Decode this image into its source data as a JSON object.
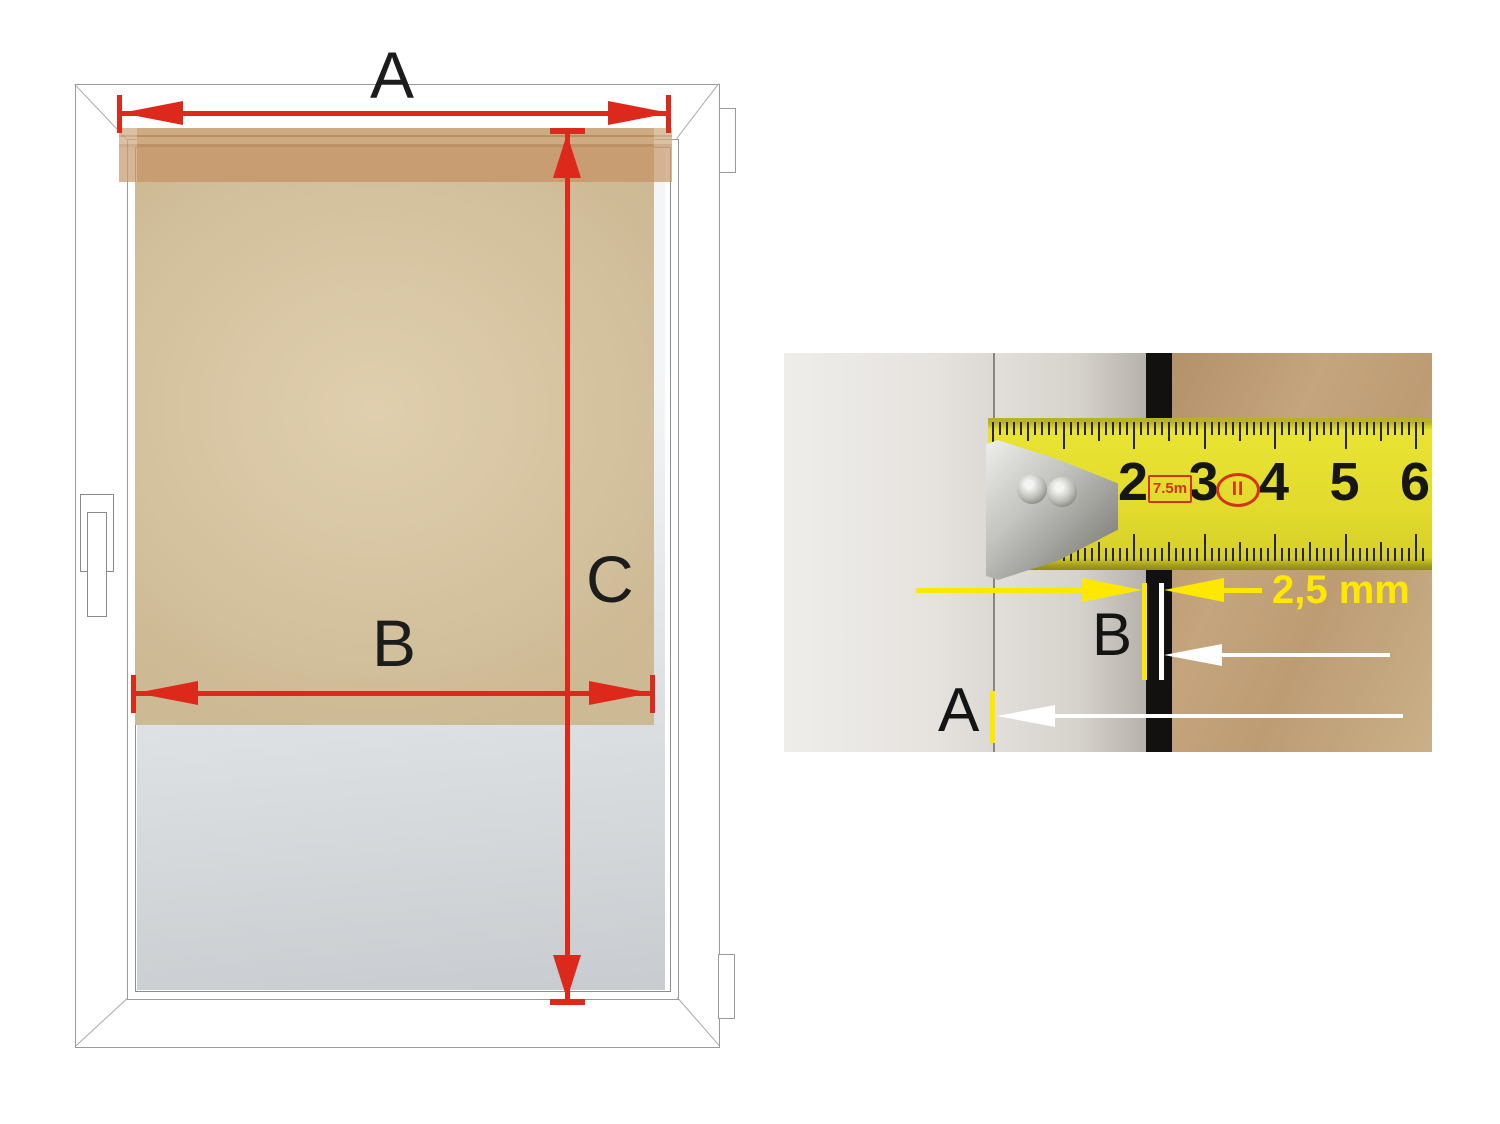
{
  "diagram": {
    "label_a": "A",
    "label_b": "B",
    "label_c": "C"
  },
  "photo": {
    "label_a": "A",
    "label_b": "B",
    "gap_label": "2,5 mm",
    "tape": {
      "numbers": [
        "2",
        "3",
        "4",
        "5",
        "6"
      ],
      "length_badge": "7.5m",
      "class_badge": "II"
    }
  },
  "colors": {
    "dimension_red": "#dd281c",
    "annotation_yellow": "#ffe800",
    "annotation_white": "#ffffff",
    "blind_fabric": "#d6c4a1",
    "blind_cassette": "#c89d72",
    "tape_yellow": "#e2db2d",
    "badge_red": "#d43317",
    "wall_tan": "#c5a57d",
    "glass_gray": "#c8ccd0"
  }
}
